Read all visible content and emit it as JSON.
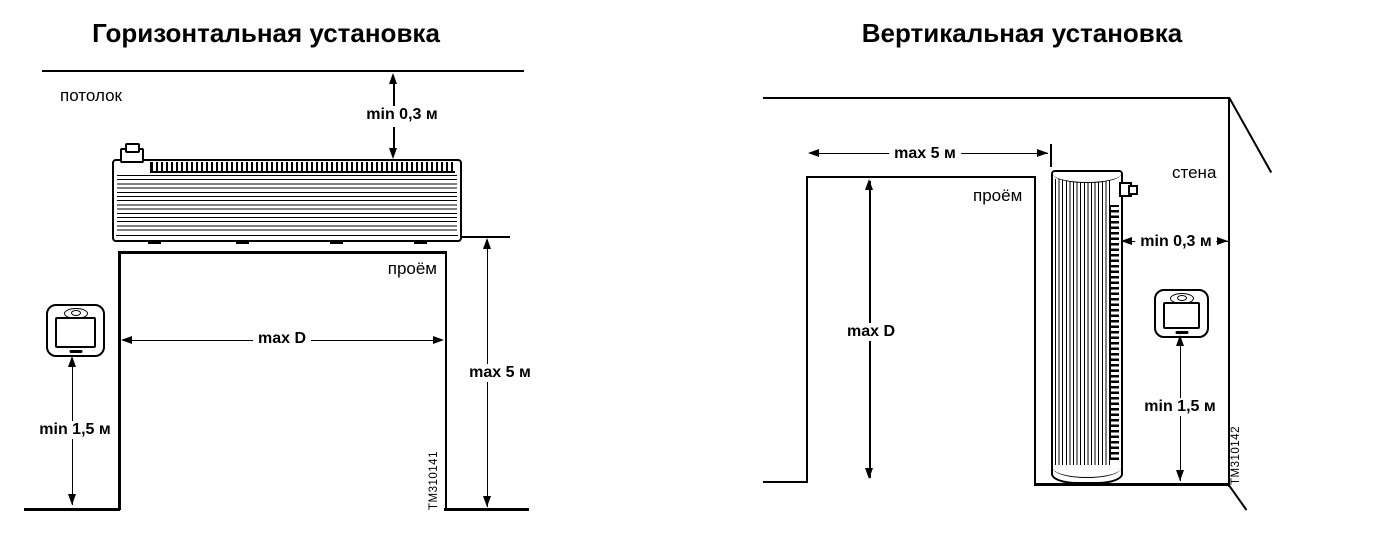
{
  "canvas": {
    "width": 1380,
    "height": 537,
    "background": "#ffffff",
    "line_color": "#000000"
  },
  "left_diagram": {
    "title": "Горизонтальная установка",
    "ceiling_label": "потолок",
    "opening_label": "проём",
    "dim_ceiling_clearance": "min 0,3 м",
    "dim_opening_width": "max D",
    "dim_max_height": "max 5 м",
    "dim_remote_height": "min 1,5 м",
    "figure_id": "TM310141"
  },
  "right_diagram": {
    "title": "Вертикальная установка",
    "wall_label": "стена",
    "opening_label": "проём",
    "dim_opening_width": "max 5 м",
    "dim_wall_clearance": "min 0,3 м",
    "dim_opening_height": "max D",
    "dim_remote_height": "min 1,5 м",
    "figure_id": "TM310142"
  }
}
